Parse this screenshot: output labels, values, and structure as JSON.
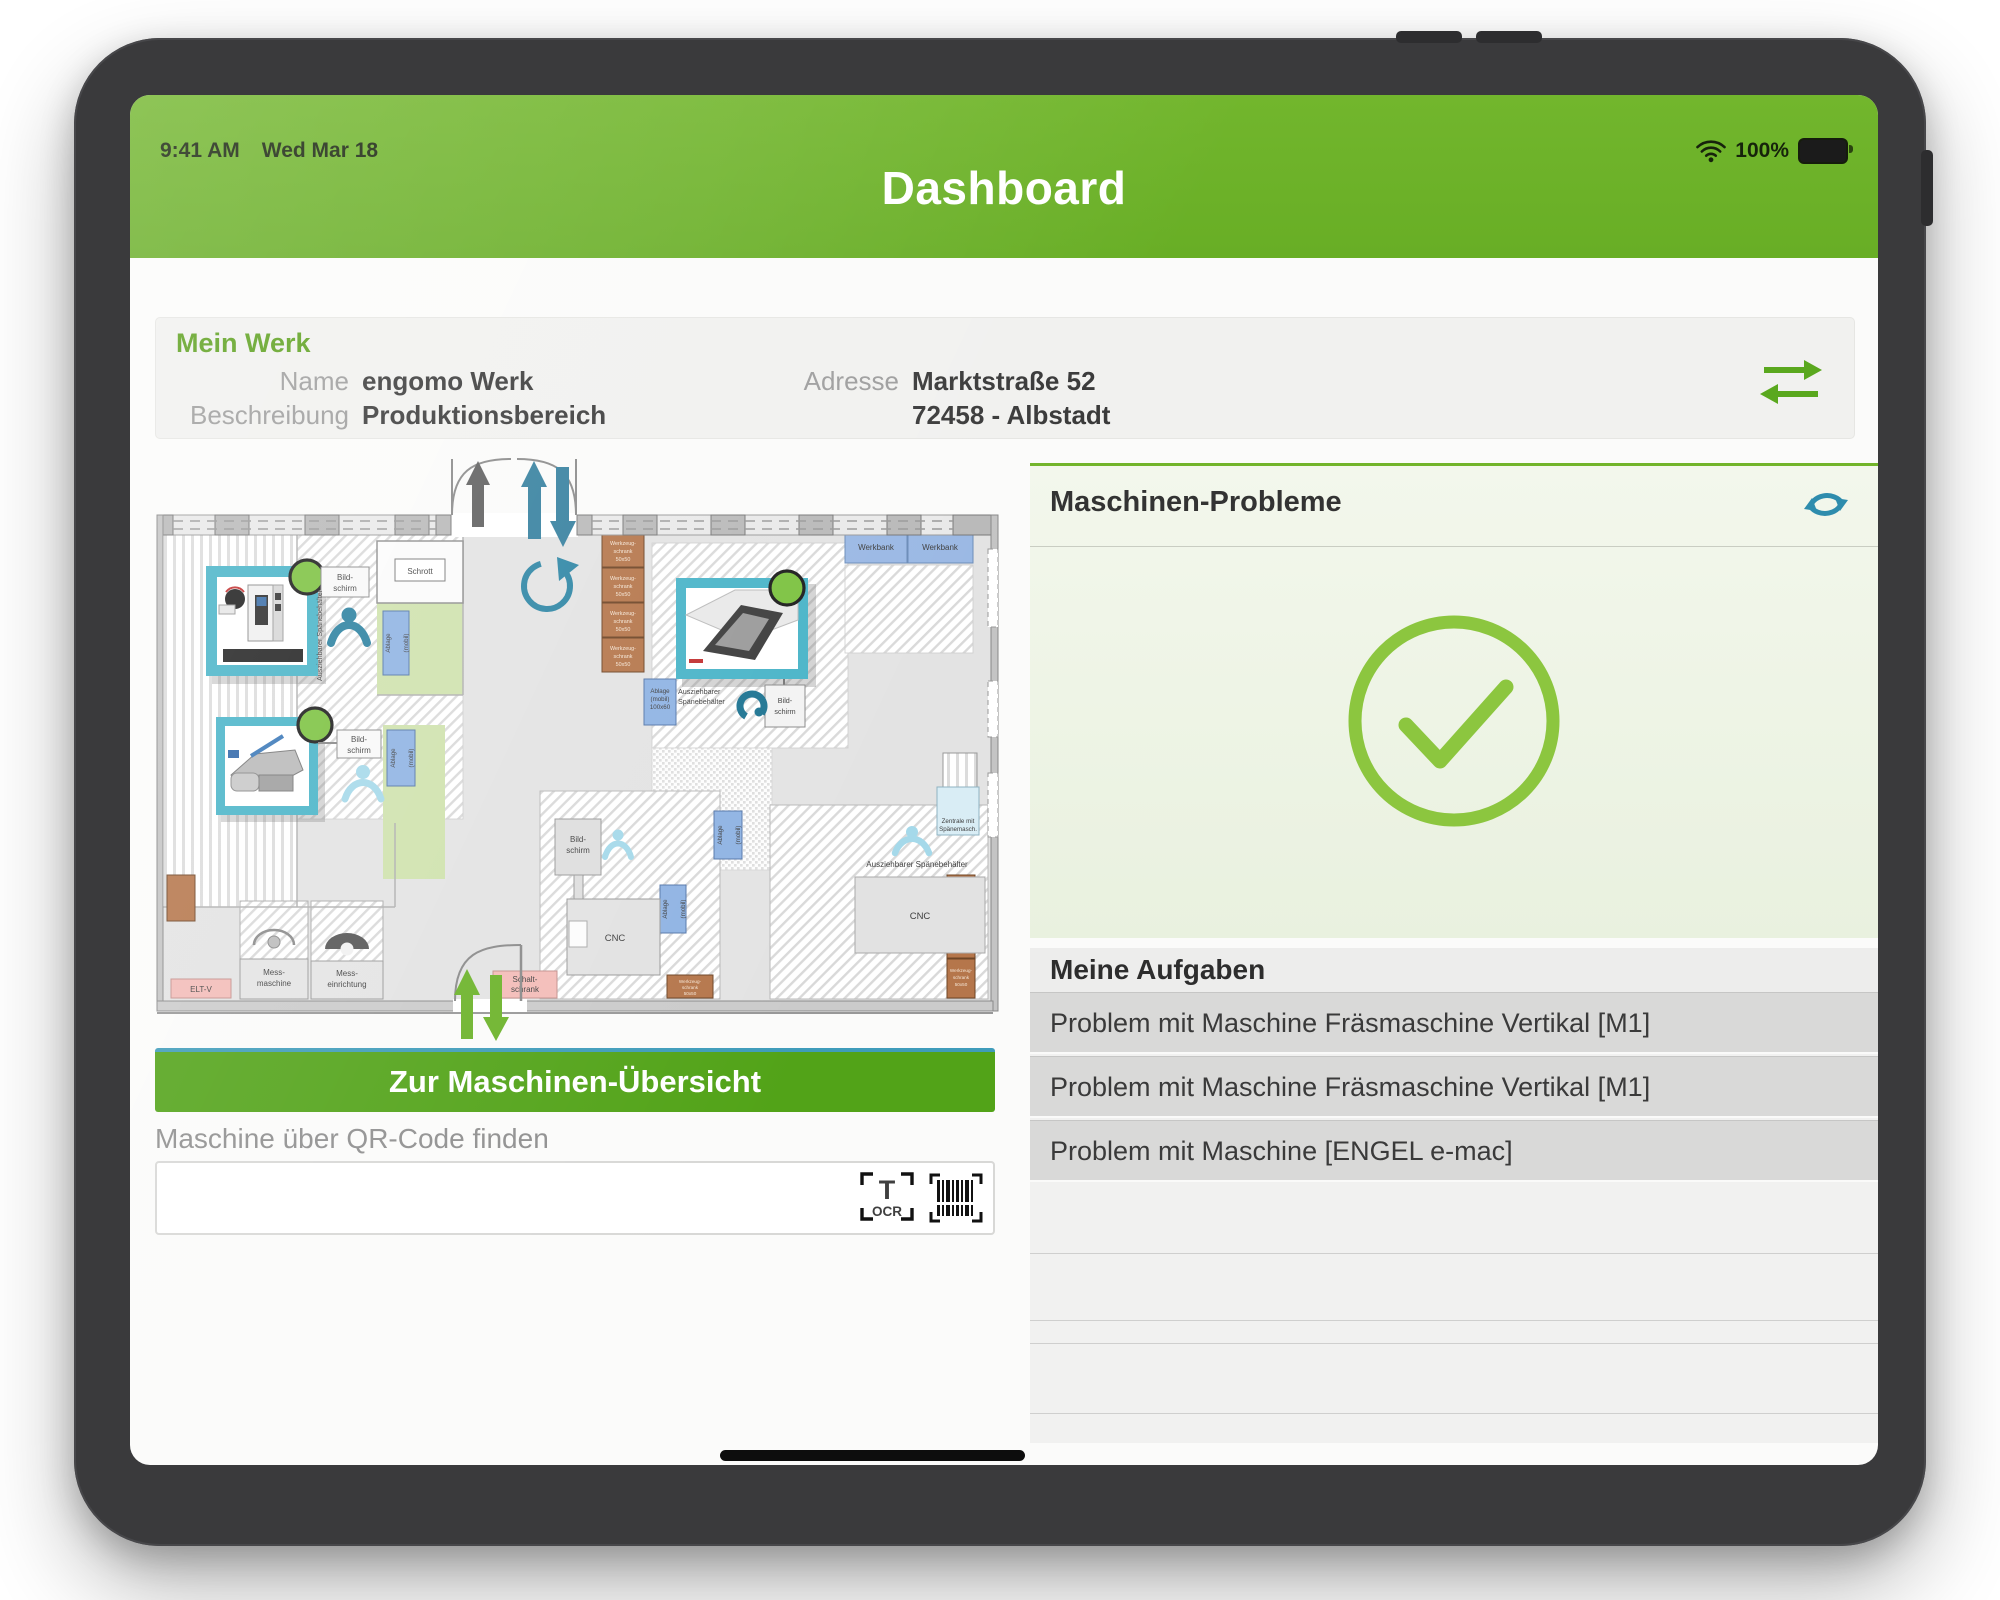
{
  "status_bar": {
    "time": "9:41 AM",
    "date": "Wed Mar 18",
    "battery": "100%"
  },
  "header": {
    "title": "Dashboard"
  },
  "colors": {
    "brand_green": "#6fb32a",
    "button_green": "#52a318",
    "accent_teal": "#2e8cad",
    "check_green": "#8cc63f",
    "task_row_gray": "#d9d9d8",
    "status_marker_green": "#7cc240"
  },
  "mein_werk": {
    "section_title": "Mein Werk",
    "name_label": "Name",
    "name_value": "engomo Werk",
    "beschreibung_label": "Beschreibung",
    "beschreibung_value": "Produktionsbereich",
    "adresse_label": "Adresse",
    "adresse_line1": "Marktstraße 52",
    "adresse_line2": "72458 - Albstadt"
  },
  "floor_plan": {
    "machine_markers": [
      {
        "machine": "Fräsmaschine Vertikal",
        "status_color": "#7cc240"
      },
      {
        "machine": "Maschine 2",
        "status_color": "#7cc240"
      },
      {
        "machine": "Maschine 3",
        "status_color": "#7cc240"
      }
    ],
    "labels": {
      "schrott": "Schrott",
      "bildschirm_l1": "Bild-",
      "bildschirm_l2": "schirm",
      "ablage_l1": "Ablage",
      "ablage_l2": "(mobil)",
      "ablage100_l1": "Ablage",
      "ablage100_l2": "(mobil)",
      "ablage100_l3": "100x60",
      "werkbank": "Werkbank",
      "werkzeug_l1": "Werkzeug-",
      "werkzeug_l2": "schrank",
      "werkzeug_l3": "50x50",
      "cnc": "CNC",
      "spaene": "Ausziehbarer Spänebehälter",
      "spaene_l1": "Ausziehbarer",
      "spaene_l2": "Spänebehälter",
      "mess_maschine_l1": "Mess-",
      "mess_maschine_l2": "maschine",
      "mess_einrichtung_l1": "Mess-",
      "mess_einrichtung_l2": "einrichtung",
      "elt_v": "ELT-V",
      "schalt_l1": "Schalt-",
      "schalt_l2": "schrank",
      "zentrale_l1": "Zentrale mit",
      "zentrale_l2": "Spänemasch."
    }
  },
  "left_column": {
    "overview_button": "Zur Maschinen-Übersicht",
    "qr_label": "Maschine über QR-Code finden",
    "ocr_label": "OCR"
  },
  "machine_problems": {
    "title": "Maschinen-Probleme"
  },
  "tasks": {
    "title": "Meine Aufgaben",
    "items": [
      "Problem mit Maschine Fräsmaschine Vertikal [M1]",
      "Problem mit Maschine Fräsmaschine Vertikal [M1]",
      "Problem mit Maschine  [ENGEL e-mac]"
    ]
  }
}
